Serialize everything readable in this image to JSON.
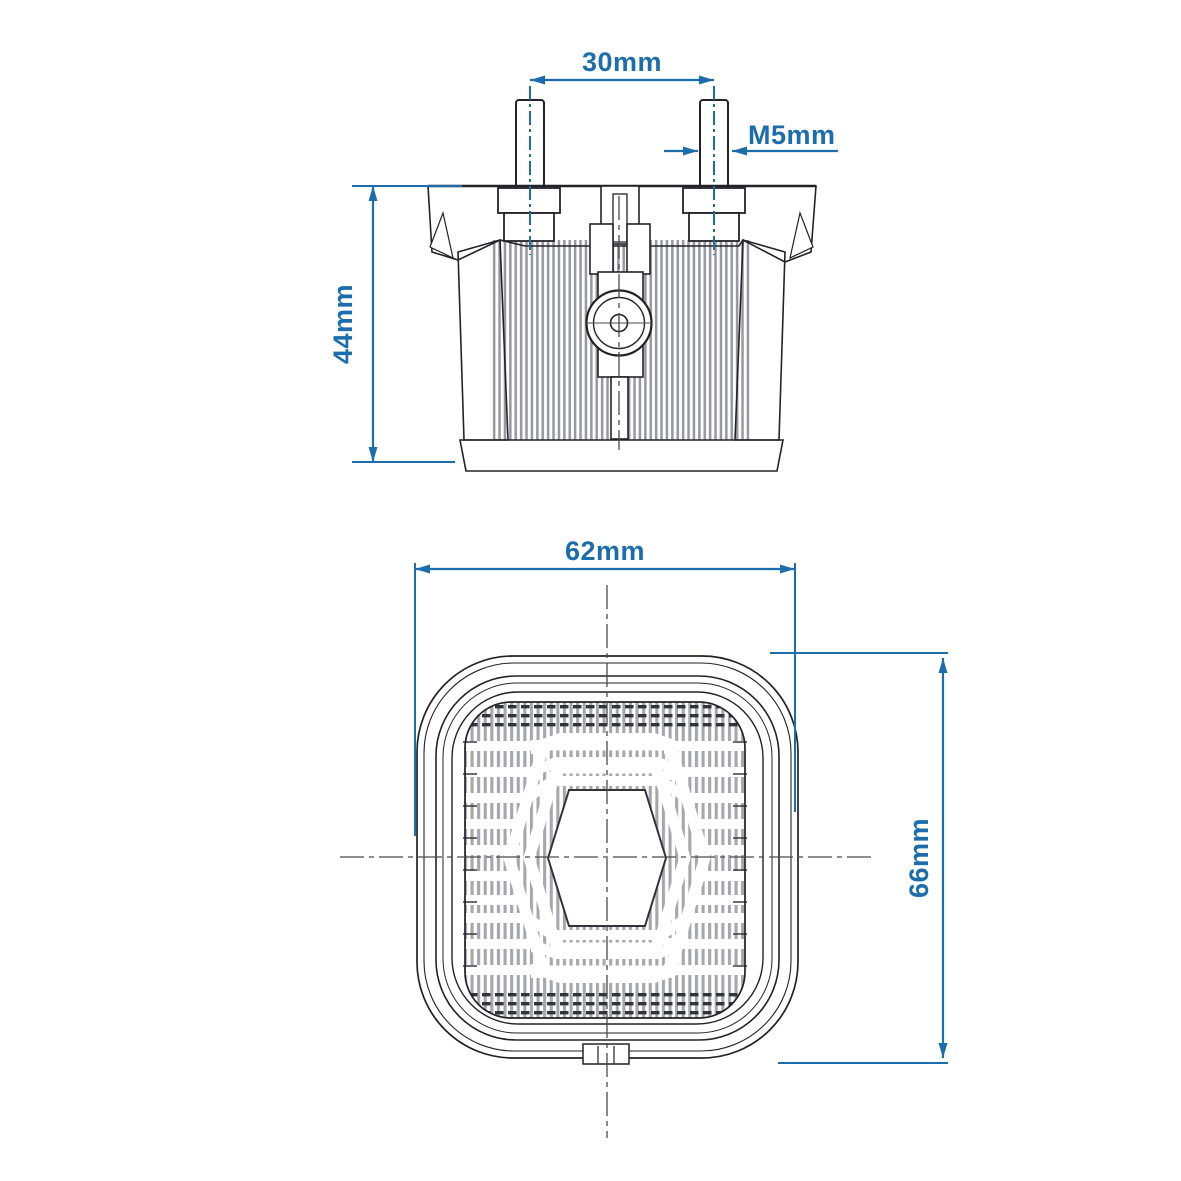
{
  "drawing": {
    "kind": "technical-drawing-lamp",
    "views": {
      "section_view": "cross-section of lamp housing with mounting studs",
      "front_view": "front view of square lens with hexagonal center"
    }
  },
  "labels": {
    "bolt_spacing": "30mm",
    "thread_size": "M5mm",
    "housing_height": "44mm",
    "lens_width": "62mm",
    "lens_height": "66mm"
  },
  "colors": {
    "dimension_blue": "#1c6dad",
    "line_dark": "#222228",
    "rib_gray_section": "#97979e",
    "rib_gray_front": "#a6a6ad",
    "background": "#ffffff"
  }
}
